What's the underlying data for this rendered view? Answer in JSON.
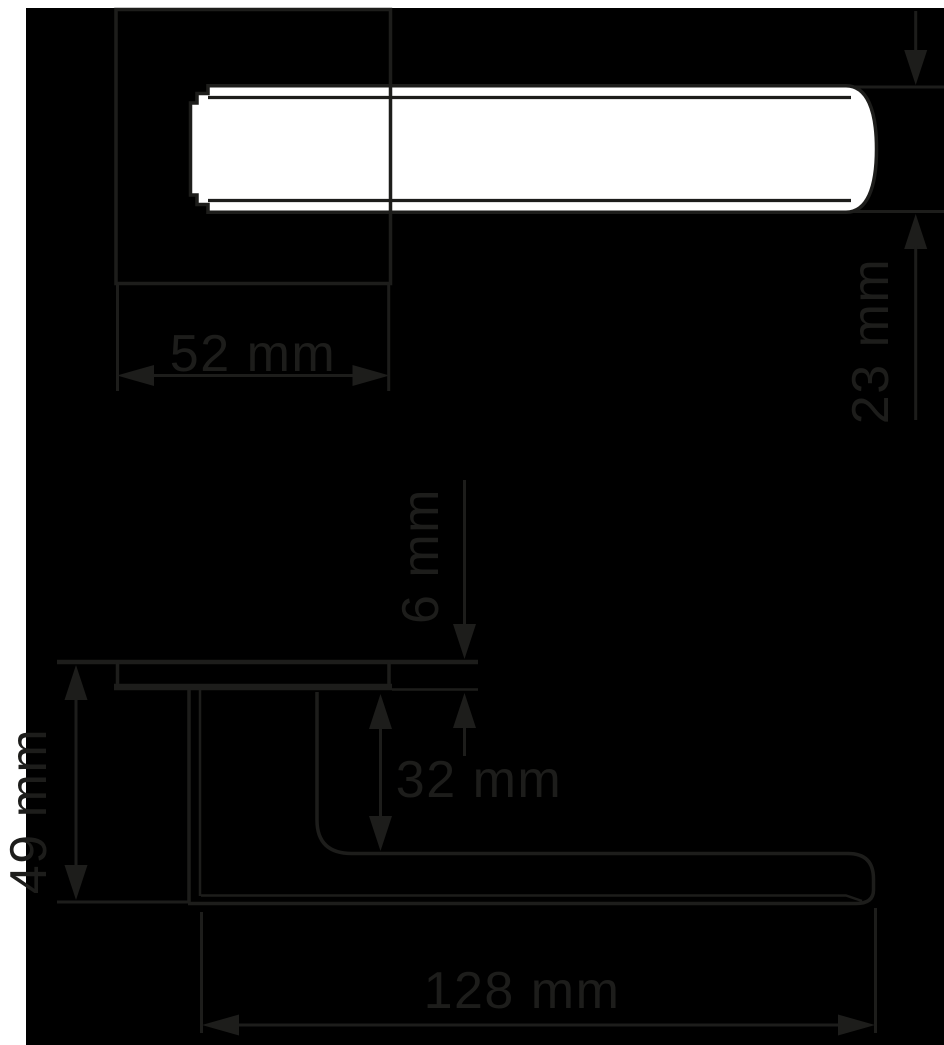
{
  "diagram": {
    "type": "technical-dimension-drawing",
    "subject": "Door lever handle on square rosette, plan view (top) and side elevation (bottom) with dimension callouts",
    "unit": "mm",
    "colors": {
      "background": "#000000",
      "line": "#1d1d1b",
      "shape_fill": "#ffffff",
      "page_margin": "#ffffff"
    },
    "views": {
      "plan": {
        "name": "plan-view",
        "description": "handle grip bar over square rosette"
      },
      "side": {
        "name": "side-view",
        "description": "rosette plate, neck and grip profile"
      }
    },
    "dimensions": {
      "rosette_width": {
        "label": "52 mm",
        "value": 52,
        "orientation": "horizontal",
        "view": "plan"
      },
      "grip_diameter": {
        "label": "23 mm",
        "value": 23,
        "orientation": "vertical",
        "view": "plan"
      },
      "rosette_thickness": {
        "label": "6 mm",
        "value": 6,
        "orientation": "vertical",
        "view": "side"
      },
      "grip_offset": {
        "label": "32 mm",
        "value": 32,
        "orientation": "vertical",
        "view": "side"
      },
      "total_projection": {
        "label": "49 mm",
        "value": 49,
        "orientation": "vertical",
        "view": "side"
      },
      "handle_length": {
        "label": "128 mm",
        "value": 128,
        "orientation": "horizontal",
        "view": "side"
      }
    }
  }
}
